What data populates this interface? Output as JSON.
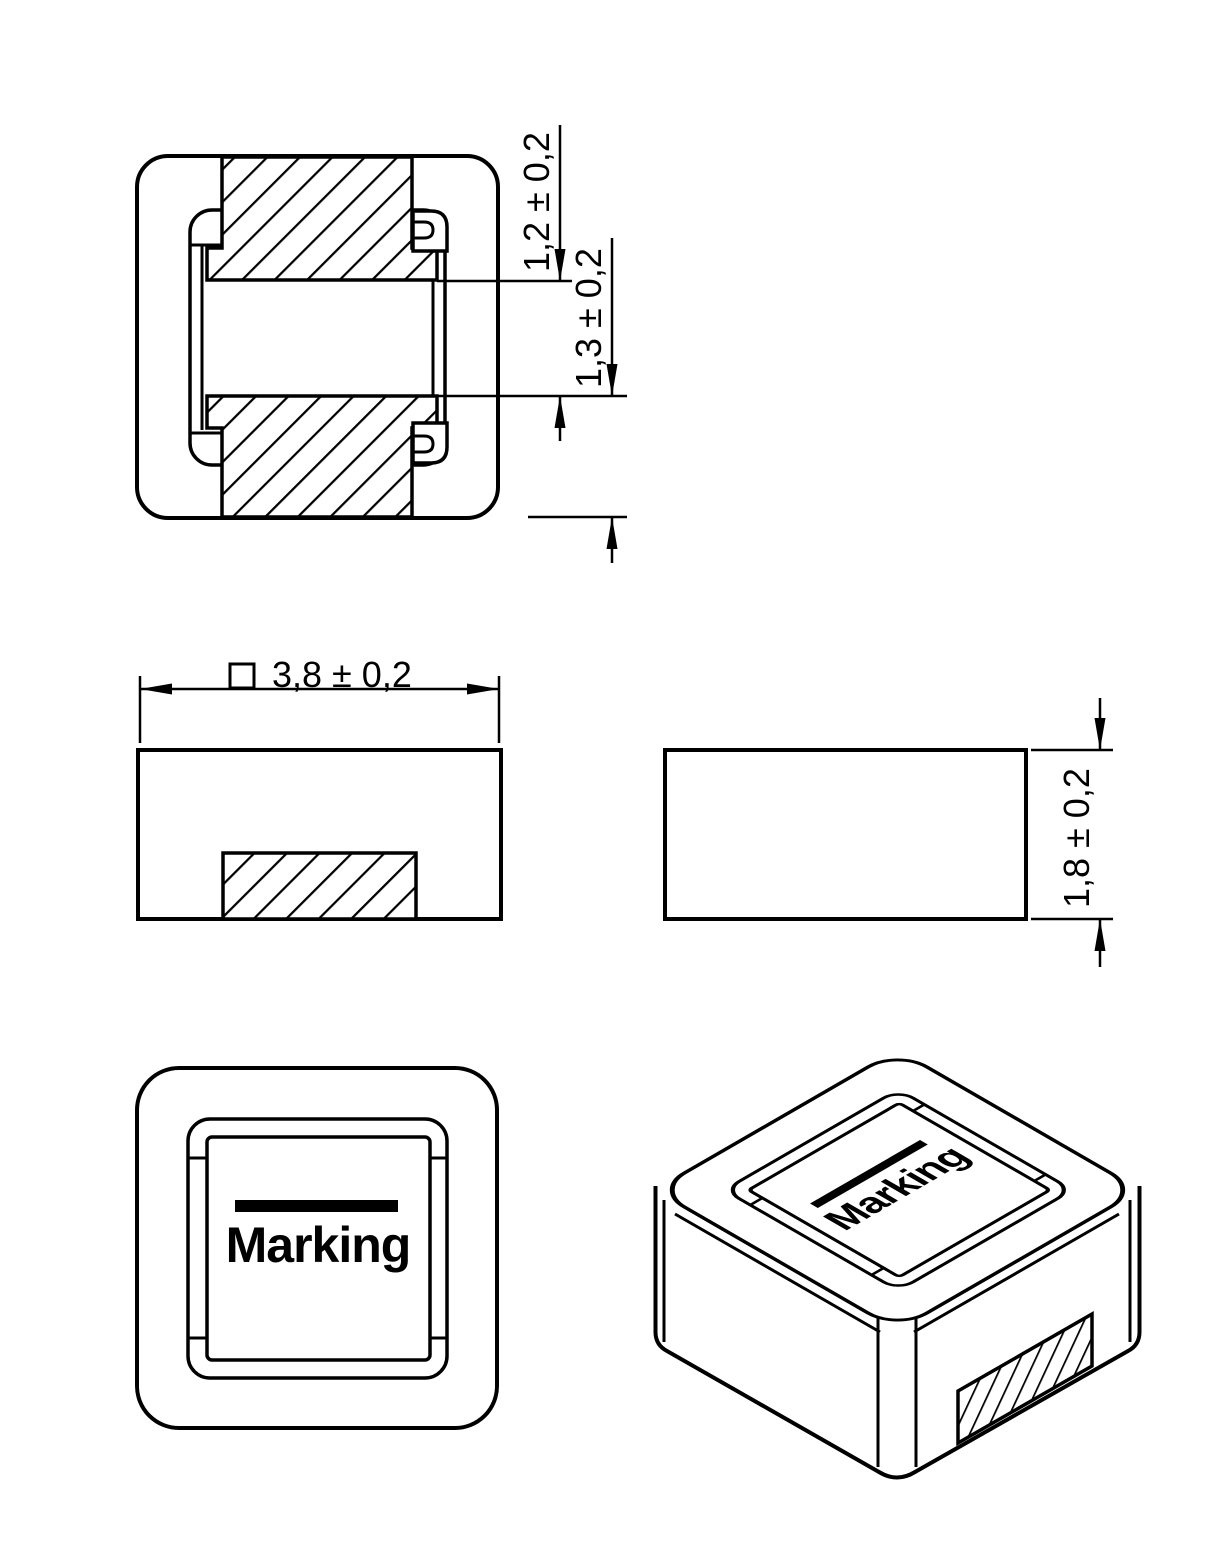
{
  "page": {
    "background": "#ffffff",
    "line_color": "#000000",
    "content_type": "component package dimension drawing"
  },
  "views": {
    "bottom_section_view": {
      "name": "bottom view with terminal cross-section",
      "dimensions": {
        "terminal_gap": "1,2 ± 0,2",
        "terminal_setback": "1,3 ± 0,2"
      }
    },
    "front_view": {
      "name": "front elevation with bottom terminal",
      "dimensions": {
        "body_width_prefix": "□",
        "body_width": "3,8 ± 0,2"
      }
    },
    "side_view": {
      "name": "side elevation",
      "dimensions": {
        "body_height": "1,8 ± 0,2"
      }
    },
    "top_view": {
      "name": "top view",
      "marking": "Marking"
    },
    "isometric_view": {
      "name": "isometric view",
      "marking": "Marking"
    }
  }
}
